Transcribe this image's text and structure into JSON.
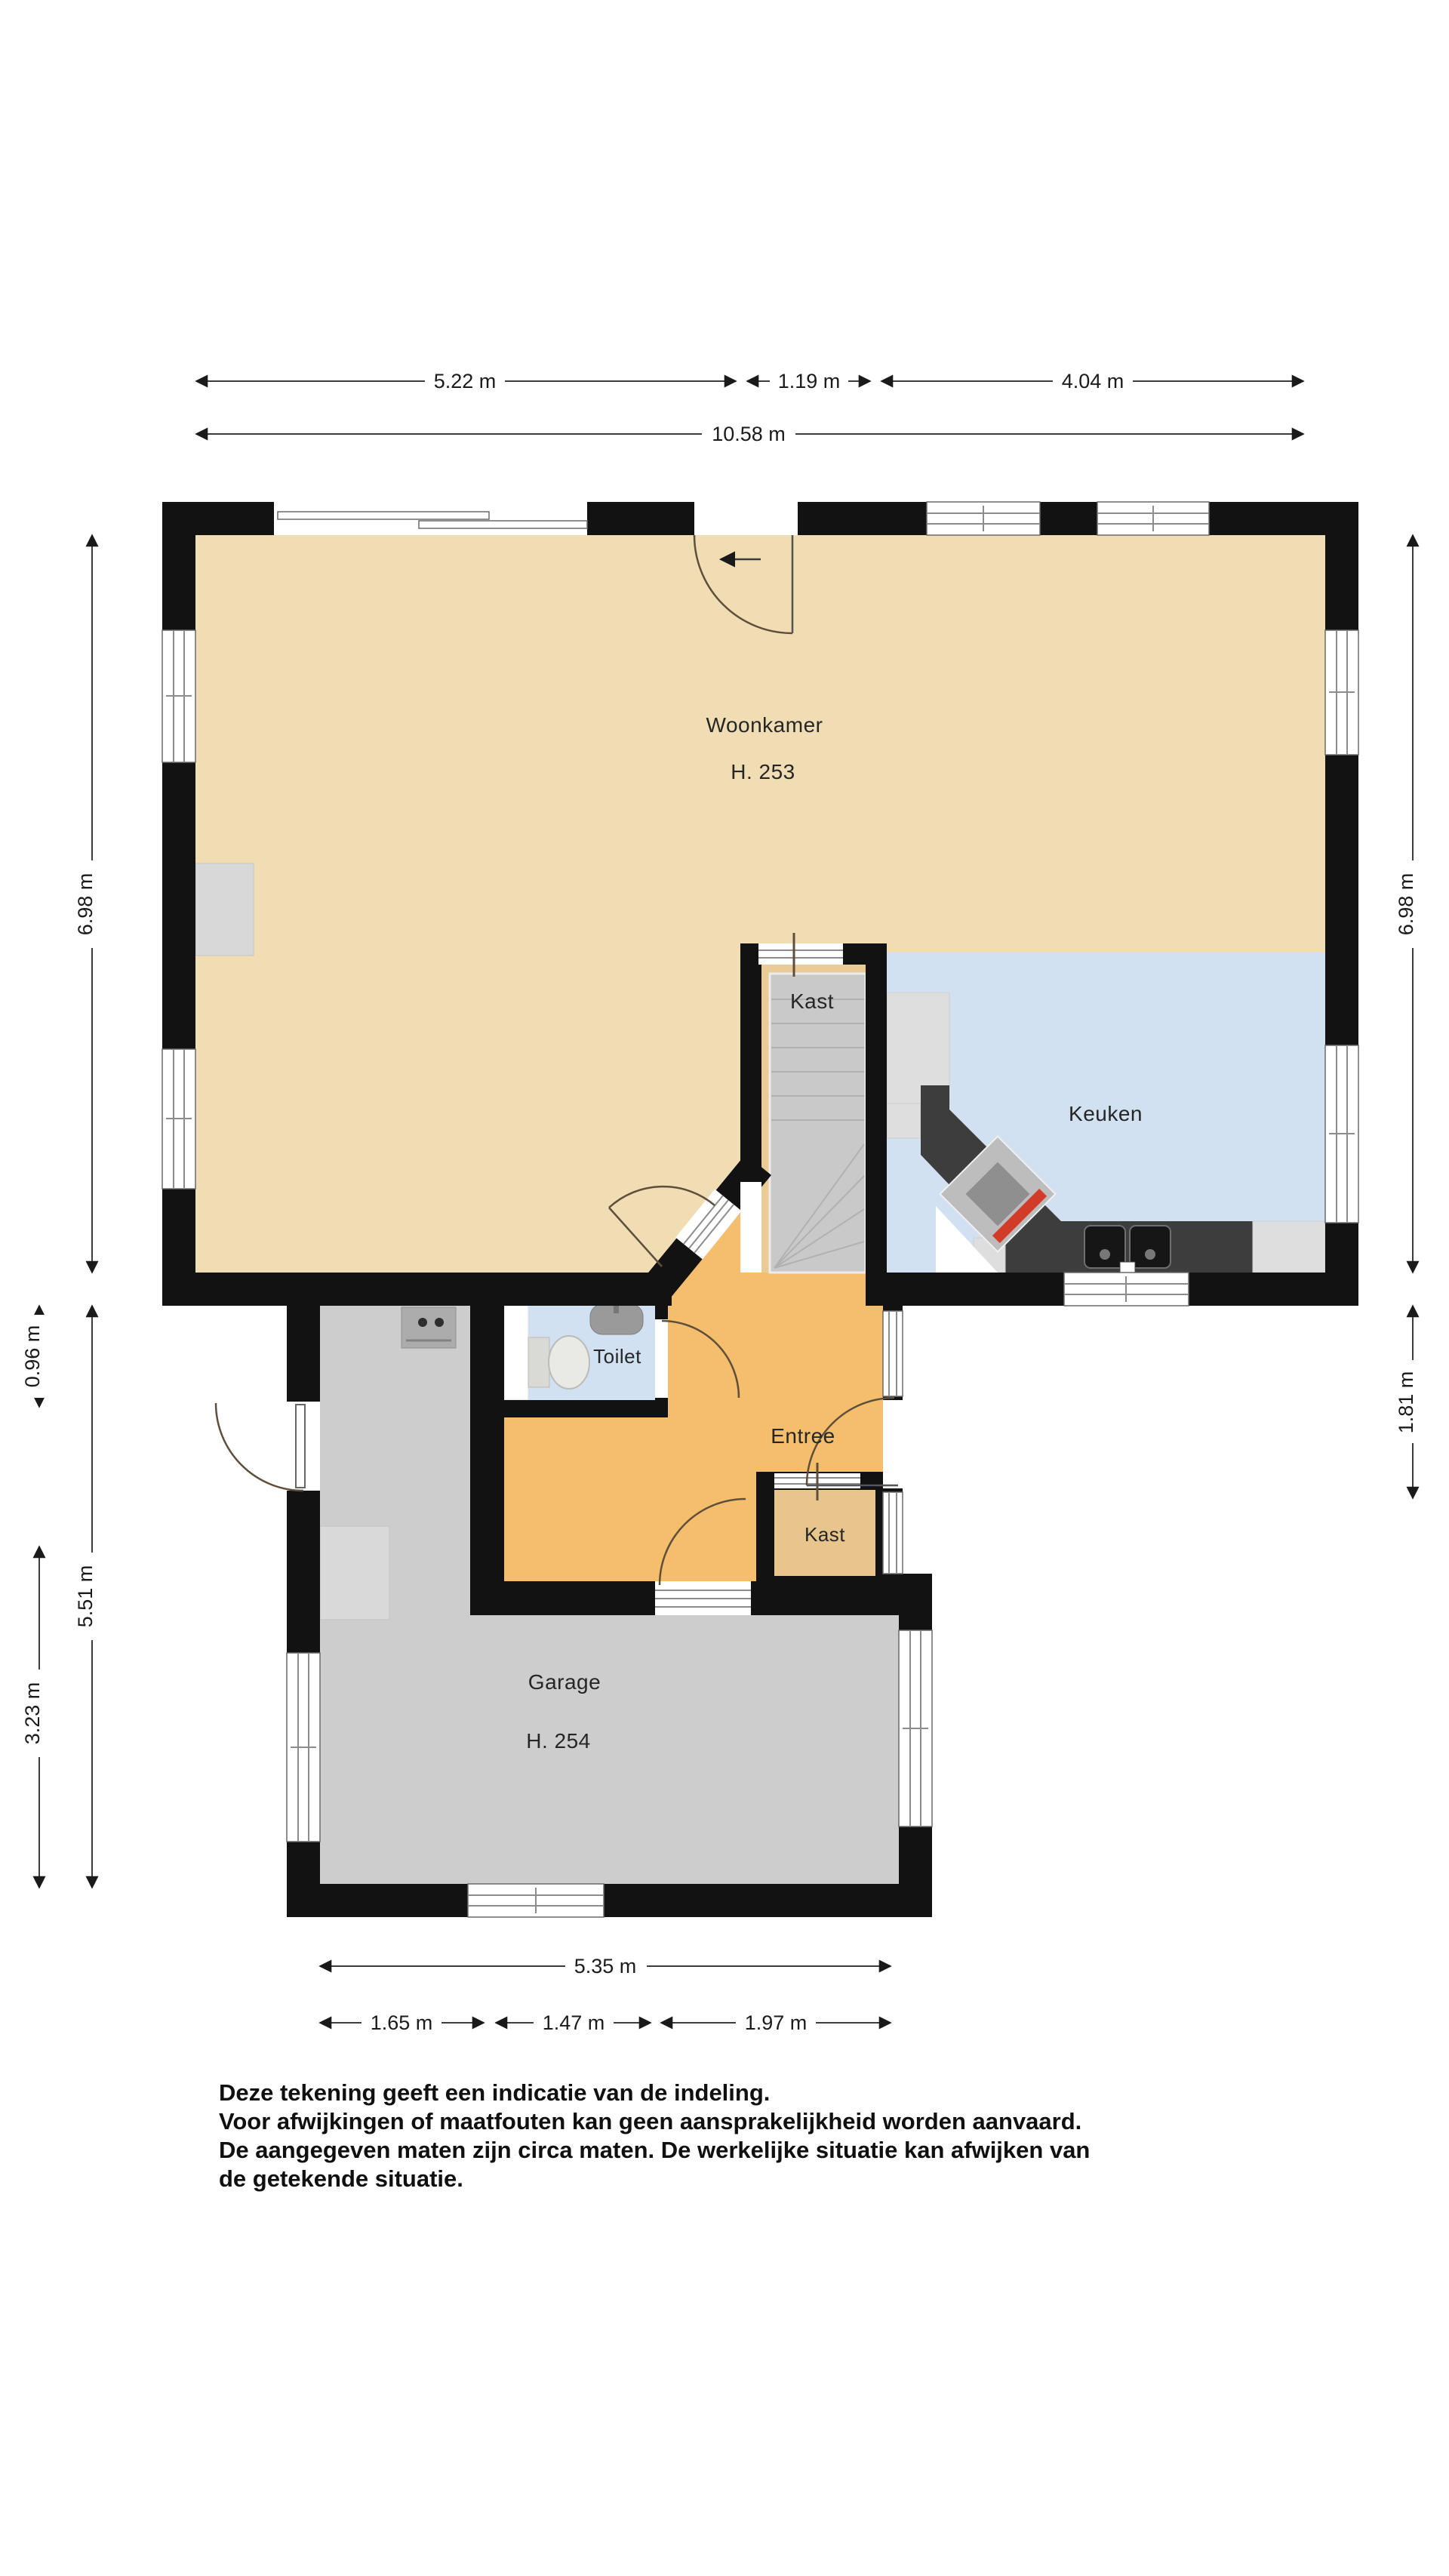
{
  "plan_type": "floor-plan (begane grond)",
  "rooms": {
    "woonkamer": {
      "label": "Woonkamer",
      "height_label": "H. 253",
      "floor_color": "#F1DDB3"
    },
    "keuken": {
      "label": "Keuken",
      "floor_color": "#D2E1F1"
    },
    "kast_boven": {
      "label": "Kast",
      "floor_color": "#EACB96"
    },
    "toilet": {
      "label": "Toilet",
      "floor_color": "#D2E1F1"
    },
    "entree": {
      "label": "Entree",
      "floor_color": "#F5BE6C"
    },
    "kast_onder": {
      "label": "Kast",
      "floor_color": "#E7C58C"
    },
    "garage": {
      "label": "Garage",
      "height_label": "H. 254",
      "floor_color": "#CDCDCD"
    }
  },
  "dimensions": {
    "top": {
      "segments": [
        "5.22 m",
        "1.19 m",
        "4.04 m"
      ],
      "total": "10.58 m"
    },
    "left": {
      "upper": "6.98 m",
      "toilet": "0.96 m",
      "lower": "5.51 m",
      "garage": "3.23 m"
    },
    "right": {
      "upper": "6.98 m",
      "entree": "1.81 m"
    },
    "bottom": {
      "total": "5.35 m",
      "segments": [
        "1.65 m",
        "1.47 m",
        "1.97 m"
      ]
    }
  },
  "disclaimer": {
    "lines": [
      "Deze tekening geeft een indicatie van de indeling.",
      "Voor  afwijkingen of maatfouten kan geen aansprakelijkheid worden aanvaard.",
      "De aangegeven maten zijn circa maten. De werkelijke situatie kan afwijken van",
      "de getekende situatie."
    ]
  },
  "colors": {
    "wall": "#121212",
    "stairs": "#C9C9C9",
    "counter_dark": "#3D3D3D",
    "appliance_light": "#DEDEDE",
    "door_arc": "#5E4F3C",
    "dimension_line": "#3C3C3C",
    "background": "#FFFFFF"
  }
}
